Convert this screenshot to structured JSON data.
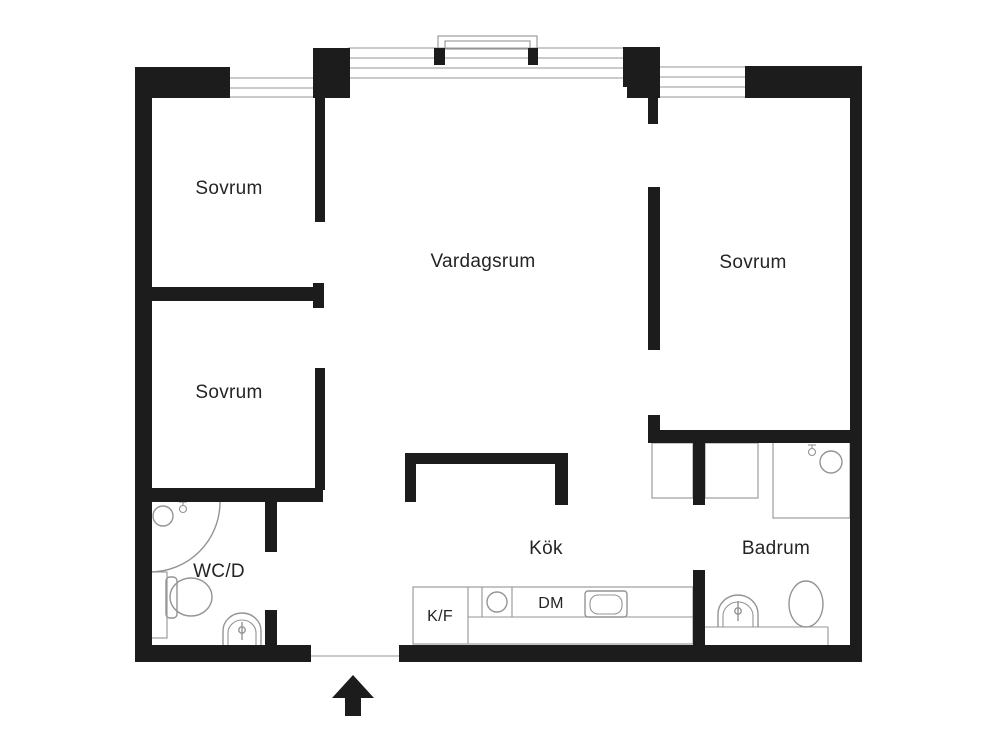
{
  "title": "Apartment floor plan",
  "colors": {
    "wall": "#1c1c1c",
    "line": "#949494",
    "text": "#242424",
    "bg": "#ffffff"
  },
  "rooms": {
    "bedroom_top_left": "Sovrum",
    "bedroom_mid_left": "Sovrum",
    "bedroom_right": "Sovrum",
    "living_room": "Vardagsrum",
    "wc": "WC/D",
    "kitchen": "Kök",
    "bathroom": "Badrum"
  },
  "appliances": {
    "fridge_freezer": "K/F",
    "dishwasher": "DM"
  },
  "symbols": {
    "entrance_arrow": "entrance direction arrow pointing up",
    "windows": [
      "left bedroom window",
      "living room window with balcony",
      "right bedroom window"
    ],
    "fixtures": [
      "wc shower drain",
      "wc door swing arc",
      "wc toilet",
      "wc sink",
      "kitchen hob circle",
      "kitchen sink",
      "bathroom shower",
      "bathroom sink",
      "bathroom toilet",
      "closets"
    ]
  }
}
